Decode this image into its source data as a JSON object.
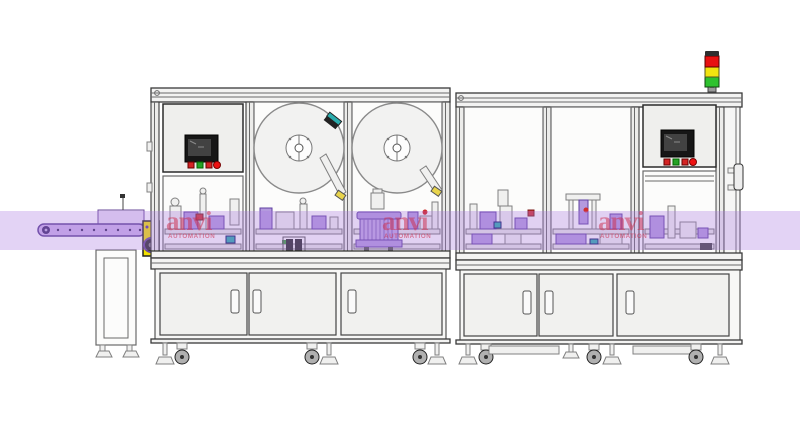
{
  "watermark": {
    "brand": "anvi",
    "subtitle": "AUTOMATION"
  },
  "colors": {
    "band": "#a97ae0",
    "tower_red": "#e81212",
    "tower_yellow": "#f2e410",
    "tower_green": "#2ec22e",
    "tower_cap": "#2f2f2f",
    "motor_box_yellow": "#f2e000",
    "button_red": "#d42424",
    "button_green": "#25a325",
    "screen_dark": "#161616",
    "screen_inner": "#424242",
    "watermark_red": "#cc2a4a",
    "accent_teal": "#2aacac",
    "accent_red": "#cf2f2f",
    "accent_green": "#3aa03a"
  },
  "left_machine": {
    "hmi_buttons": [
      "red",
      "green",
      "red",
      "red"
    ]
  },
  "right_machine": {
    "hmi_buttons": [
      "red",
      "green",
      "red",
      "red"
    ]
  }
}
